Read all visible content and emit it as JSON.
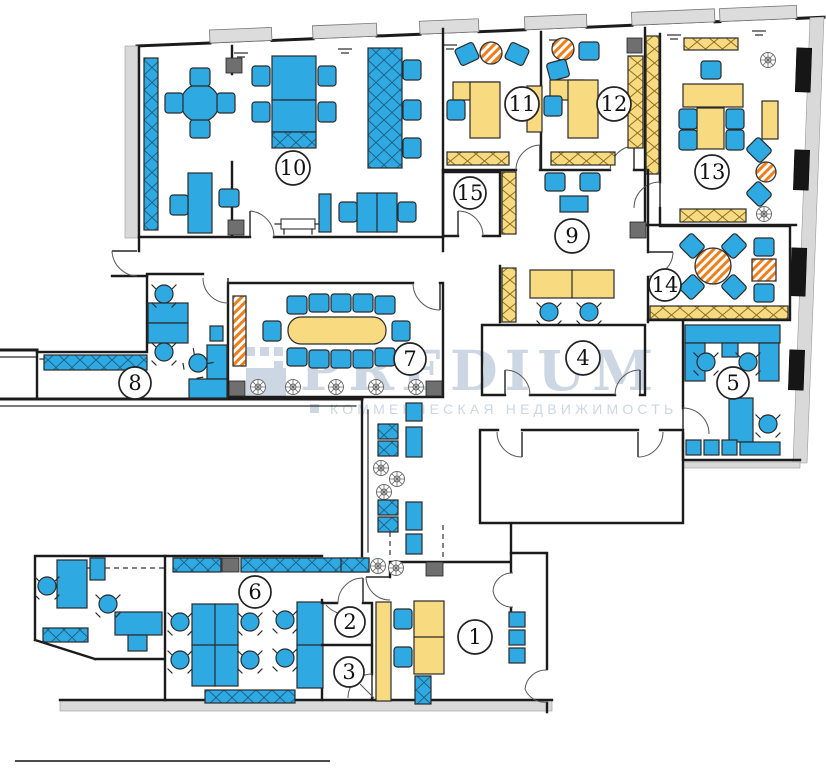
{
  "watermark": {
    "brand": "PREDIUM",
    "tagline": "КОММЕРЧЕСКАЯ НЕДВИЖИМОСТЬ"
  },
  "rooms": {
    "r1": "1",
    "r2": "2",
    "r3": "3",
    "r4": "4",
    "r5": "5",
    "r6": "6",
    "r7": "7",
    "r8": "8",
    "r9": "9",
    "r10": "10",
    "r11": "11",
    "r12": "12",
    "r13": "13",
    "r14": "14",
    "r15": "15"
  },
  "colors": {
    "furniture_blue": "#2fa9e1",
    "furniture_yellow": "#f8db80",
    "accent_orange": "#ee7f1d",
    "outline": "#2a2a2a",
    "watermark": "#c7d3e0"
  }
}
